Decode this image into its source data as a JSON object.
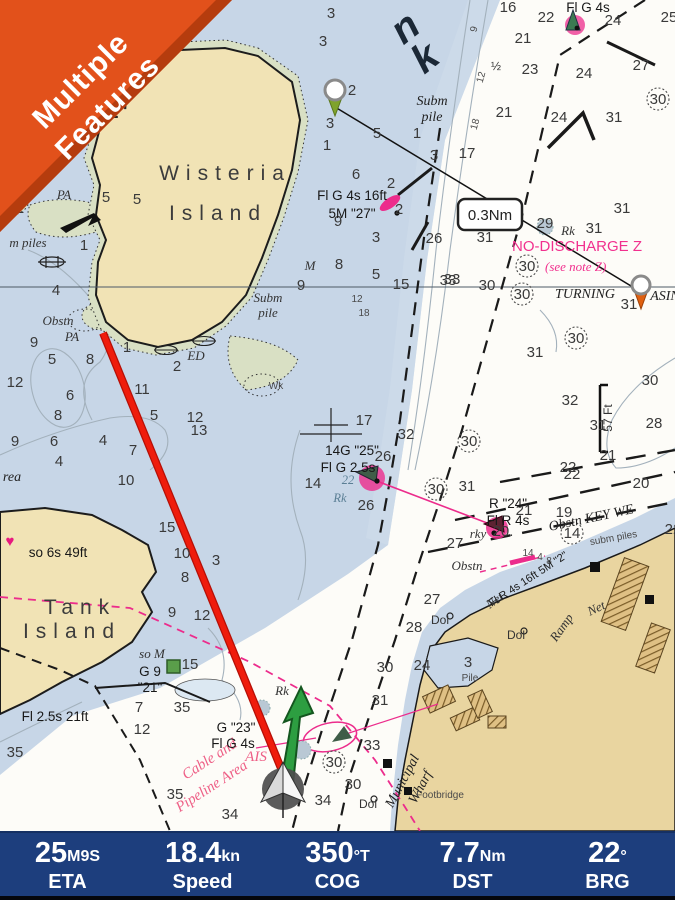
{
  "ribbon": {
    "line1": "Multiple",
    "line2": "Features",
    "color": "#e2511b"
  },
  "route": {
    "distance": "0.3Nm"
  },
  "colors": {
    "water": "#c7d6e7",
    "deep_white": "#fdfcf8",
    "land": "#f1e3b5",
    "land_city": "#e9d5a0",
    "shoal_green": "#d9e0c4",
    "magenta": "#ec2c8c",
    "track_red": "#e8150a",
    "cog_arrow_green": "#2d9e41",
    "navbar_bg": "#1d3e7d",
    "ribbon": "#e2511b"
  },
  "navbar": {
    "items": [
      {
        "value": "25",
        "unit": "M9S",
        "label": "ETA"
      },
      {
        "value": "18.4",
        "unit": "kn",
        "label": "Speed"
      },
      {
        "value": "350",
        "unit": "°T",
        "label": "COG"
      },
      {
        "value": "7.7",
        "unit": "Nm",
        "label": "DST"
      },
      {
        "value": "22",
        "unit": "°",
        "label": "BRG"
      }
    ]
  },
  "chart": {
    "soundings": [
      [
        7,
        163,
        53
      ],
      [
        3,
        331,
        18
      ],
      [
        3,
        323,
        46
      ],
      [
        2,
        352,
        95
      ],
      [
        8,
        86,
        126
      ],
      [
        1,
        327,
        150
      ],
      [
        3,
        330,
        128
      ],
      [
        16,
        508,
        12
      ],
      [
        22,
        546,
        22
      ],
      [
        24,
        613,
        25
      ],
      [
        25,
        669,
        22
      ],
      [
        21,
        523,
        43
      ],
      [
        23,
        530,
        74
      ],
      [
        24,
        584,
        78
      ],
      [
        27,
        641,
        70
      ],
      [
        21,
        504,
        117
      ],
      [
        24,
        559,
        122
      ],
      [
        31,
        614,
        122
      ],
      [
        30,
        658,
        104,
        "circ"
      ],
      [
        5,
        377,
        138
      ],
      [
        1,
        417,
        138
      ],
      [
        3,
        434,
        160
      ],
      [
        17,
        467,
        158
      ],
      [
        6,
        356,
        179
      ],
      [
        2,
        391,
        188
      ],
      [
        2,
        399,
        214
      ],
      [
        9,
        338,
        226
      ],
      [
        3,
        376,
        242
      ],
      [
        26,
        434,
        243
      ],
      [
        8,
        339,
        269
      ],
      [
        5,
        376,
        279
      ],
      [
        15,
        401,
        289
      ],
      [
        33,
        448,
        285
      ],
      [
        9,
        301,
        290
      ],
      [
        5,
        106,
        202
      ],
      [
        2,
        20,
        213
      ],
      [
        1,
        84,
        250
      ],
      [
        5,
        137,
        204
      ],
      [
        4,
        56,
        295
      ],
      [
        9,
        34,
        347
      ],
      [
        5,
        52,
        364
      ],
      [
        12,
        15,
        387
      ],
      [
        8,
        90,
        364
      ],
      [
        6,
        70,
        400
      ],
      [
        8,
        58,
        420
      ],
      [
        11,
        142,
        394
      ],
      [
        5,
        154,
        420
      ],
      [
        1,
        127,
        352
      ],
      [
        2,
        177,
        371
      ],
      [
        13,
        199,
        435
      ],
      [
        12,
        195,
        422
      ],
      [
        9,
        15,
        446
      ],
      [
        6,
        54,
        446
      ],
      [
        4,
        103,
        445
      ],
      [
        4,
        59,
        466
      ],
      [
        7,
        133,
        455
      ],
      [
        10,
        126,
        485
      ],
      [
        31,
        485,
        242
      ],
      [
        33,
        452,
        284
      ],
      [
        30,
        487,
        290
      ],
      [
        30,
        522,
        299,
        "circ"
      ],
      [
        30,
        527,
        271,
        "circ"
      ],
      [
        29,
        545,
        228
      ],
      [
        31,
        594,
        233
      ],
      [
        31,
        622,
        213
      ],
      [
        31,
        629,
        309
      ],
      [
        30,
        576,
        343,
        "circ"
      ],
      [
        31,
        535,
        357
      ],
      [
        30,
        650,
        385
      ],
      [
        32,
        570,
        405
      ],
      [
        31,
        598,
        430
      ],
      [
        28,
        654,
        428
      ],
      [
        21,
        608,
        460
      ],
      [
        22,
        568,
        472
      ],
      [
        17,
        364,
        425
      ],
      [
        32,
        406,
        439
      ],
      [
        26,
        383,
        461
      ],
      [
        14,
        313,
        488
      ],
      [
        26,
        366,
        510
      ],
      [
        30,
        436,
        494,
        "circ"
      ],
      [
        31,
        467,
        491
      ],
      [
        30,
        469,
        446,
        "circ"
      ],
      [
        22,
        572,
        479
      ],
      [
        20,
        641,
        488
      ],
      [
        21,
        524,
        515
      ],
      [
        19,
        564,
        517
      ],
      [
        27,
        455,
        548
      ],
      [
        14,
        572,
        538,
        "circ"
      ],
      [
        22,
        673,
        534
      ],
      [
        27,
        432,
        604
      ],
      [
        28,
        414,
        632
      ],
      [
        24,
        422,
        670
      ],
      [
        30,
        385,
        672
      ],
      [
        31,
        380,
        705
      ],
      [
        33,
        372,
        750
      ],
      [
        15,
        167,
        532
      ],
      [
        10,
        182,
        558
      ],
      [
        8,
        185,
        582
      ],
      [
        3,
        216,
        565
      ],
      [
        9,
        172,
        617
      ],
      [
        12,
        202,
        620
      ],
      [
        15,
        190,
        669
      ],
      [
        7,
        139,
        712
      ],
      [
        35,
        182,
        712
      ],
      [
        12,
        142,
        734
      ],
      [
        35,
        175,
        799
      ],
      [
        34,
        230,
        819
      ],
      [
        35,
        15,
        757
      ],
      [
        30,
        334,
        767,
        "circ"
      ],
      [
        30,
        353,
        789
      ],
      [
        34,
        323,
        805
      ],
      [
        12,
        357,
        302,
        "tiny"
      ],
      [
        18,
        364,
        316,
        "tiny"
      ],
      [
        14,
        528,
        556,
        "tiny"
      ],
      [
        4,
        540,
        560,
        "tiny"
      ],
      [
        8,
        549,
        564,
        "tiny"
      ]
    ],
    "labels": [
      [
        "Wisteria",
        225,
        180,
        "place"
      ],
      [
        "Island",
        218,
        220,
        "place"
      ],
      [
        "Tank",
        80,
        614,
        "place"
      ],
      [
        "Island",
        72,
        638,
        "place"
      ],
      [
        "Subm",
        432,
        105,
        "it2"
      ],
      [
        "pile",
        432,
        121,
        "it2"
      ],
      [
        "Subm",
        268,
        302,
        "it"
      ],
      [
        "pile",
        268,
        317,
        "it"
      ],
      [
        "Fl G 4s 16ft",
        352,
        200,
        "nav"
      ],
      [
        "5M \"27\"",
        352,
        218,
        "nav"
      ],
      [
        "Fl G 4s",
        588,
        12,
        "nav"
      ],
      [
        "NO-DISCHARGE Z",
        512,
        251,
        "mag",
        0,
        "s"
      ],
      [
        "(see note Z)",
        545,
        271,
        "magit",
        0,
        "s"
      ],
      [
        "TURNING",
        585,
        298,
        "it2"
      ],
      [
        "ASIN",
        665,
        300,
        "it2"
      ],
      [
        "Rk",
        568,
        235,
        "it"
      ],
      [
        "Obstn",
        58,
        325,
        "it"
      ],
      [
        "PA",
        72,
        341,
        "it"
      ],
      [
        "PA",
        64,
        199,
        "it"
      ],
      [
        "m piles",
        28,
        247,
        "it"
      ],
      [
        "ED",
        196,
        360,
        "it"
      ],
      [
        "Wk",
        276,
        389,
        "tiny"
      ],
      [
        "M",
        310,
        270,
        "it"
      ],
      [
        "so M",
        152,
        658,
        "it"
      ],
      [
        "G 9",
        150,
        676,
        "nav"
      ],
      [
        "\"21\"",
        150,
        692,
        "nav"
      ],
      [
        "so 6s 49ft",
        58,
        557,
        "nav"
      ],
      [
        "Fl 2.5s 21ft",
        55,
        721,
        "nav"
      ],
      [
        "14G \"25\"",
        352,
        455,
        "nav"
      ],
      [
        "Fl G 2.5s",
        348,
        472,
        "nav"
      ],
      [
        "22",
        348,
        484,
        "rock"
      ],
      [
        "Rk",
        340,
        502,
        "rock"
      ],
      [
        "R \"24\"",
        508,
        508,
        "nav"
      ],
      [
        "Fl R 4s",
        508,
        525,
        "nav"
      ],
      [
        "rky",
        478,
        538,
        "it"
      ],
      [
        "20.",
        503,
        536,
        "snd"
      ],
      [
        "Obstn KEY WE",
        592,
        522,
        "it2",
        -12
      ],
      [
        "subm piles",
        614,
        541,
        "tiny",
        -10
      ],
      [
        "Fl R 4s 16ft 5M \"2\"",
        530,
        582,
        "navs",
        -33
      ],
      [
        "Net",
        497,
        604,
        "it",
        -35
      ],
      [
        "Net",
        598,
        612,
        "it",
        -25
      ],
      [
        "Dol",
        440,
        624,
        "small"
      ],
      [
        "Dol",
        516,
        639,
        "small"
      ],
      [
        "Dol",
        368,
        808,
        "small"
      ],
      [
        "Ramp",
        565,
        630,
        "it",
        -55
      ],
      [
        "Pile",
        470,
        681,
        "tiny"
      ],
      [
        "3",
        468,
        667,
        "snd"
      ],
      [
        "Municipal",
        406,
        783,
        "it2",
        -62
      ],
      [
        "Wharf",
        424,
        789,
        "it2",
        -62
      ],
      [
        "Footbridge",
        440,
        798,
        "tiny"
      ],
      [
        "Obstn",
        467,
        570,
        "it"
      ],
      [
        "57 Ft",
        612,
        418,
        "small",
        -90
      ],
      [
        "Cable and",
        212,
        763,
        "mag2",
        -33
      ],
      [
        "Pipeline Area",
        214,
        790,
        "mag2",
        -33
      ],
      [
        "AIS",
        256,
        761,
        "mag2"
      ],
      [
        "G \"23\"",
        236,
        732,
        "nav"
      ],
      [
        "Fl G 4s",
        233,
        748,
        "nav"
      ],
      [
        "Rk",
        282,
        695,
        "it"
      ],
      [
        "rea",
        12,
        481,
        "it2"
      ],
      [
        "n",
        413,
        38,
        "big",
        -38
      ],
      [
        "k",
        433,
        68,
        "big",
        -38
      ],
      [
        "½",
        496,
        70,
        "small"
      ],
      [
        "31\"",
        112,
        118,
        "coord"
      ],
      [
        "♥",
        10,
        546,
        "magsym"
      ],
      [
        "9",
        477,
        30,
        "tiny",
        -75
      ],
      [
        "12",
        484,
        78,
        "tiny",
        -75
      ],
      [
        "18",
        478,
        125,
        "tiny",
        -75
      ]
    ]
  }
}
